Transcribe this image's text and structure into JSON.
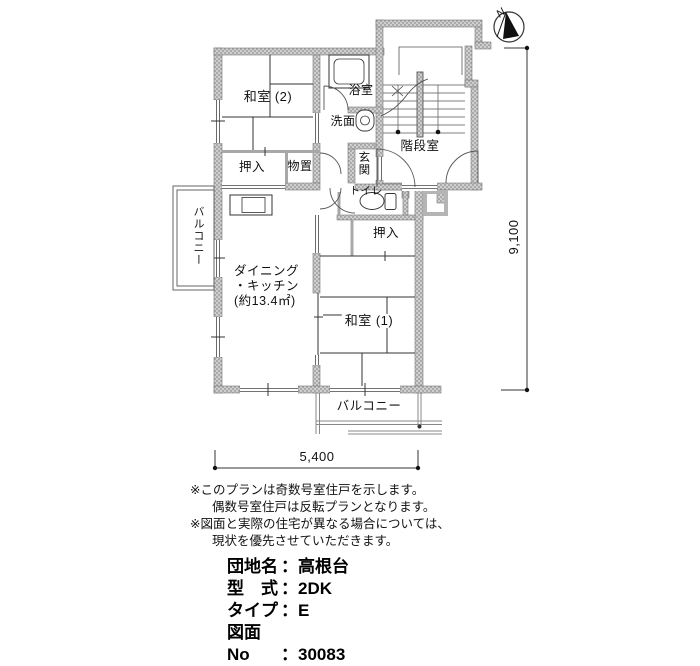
{
  "compass": {
    "north": "N"
  },
  "dimensions": {
    "height": "9,100",
    "width": "5,400"
  },
  "rooms": {
    "washitsu2": "和室 (2)",
    "bath": "浴室",
    "washroom": "洗面",
    "stair": "階段室",
    "oshiire_top": "押入",
    "storage": "物置",
    "genkan": "玄関",
    "toilet": "トイレ",
    "oshiire_right": "押入",
    "balcony_left": "バルコニー",
    "dk_line1": "ダイニング",
    "dk_line2": "・キッチン",
    "dk_line3": "(約13.4㎡)",
    "washitsu1": "和室 (1)",
    "balcony_bottom": "バルコニー"
  },
  "notes": {
    "line1": "※このプランは奇数号室住戸を示します。",
    "line2": "偶数号室住戸は反転プランとなります。",
    "line3": "※図面と実際の住宅が異なる場合については、",
    "line4": "現状を優先させていただきます。"
  },
  "info": {
    "separator": "：",
    "rows": [
      {
        "label": "団地名",
        "value": "高根台"
      },
      {
        "label": "型　式",
        "value": "2DK"
      },
      {
        "label": "タイプ",
        "value": "E"
      },
      {
        "label": "図面No",
        "value": "30083"
      }
    ]
  }
}
